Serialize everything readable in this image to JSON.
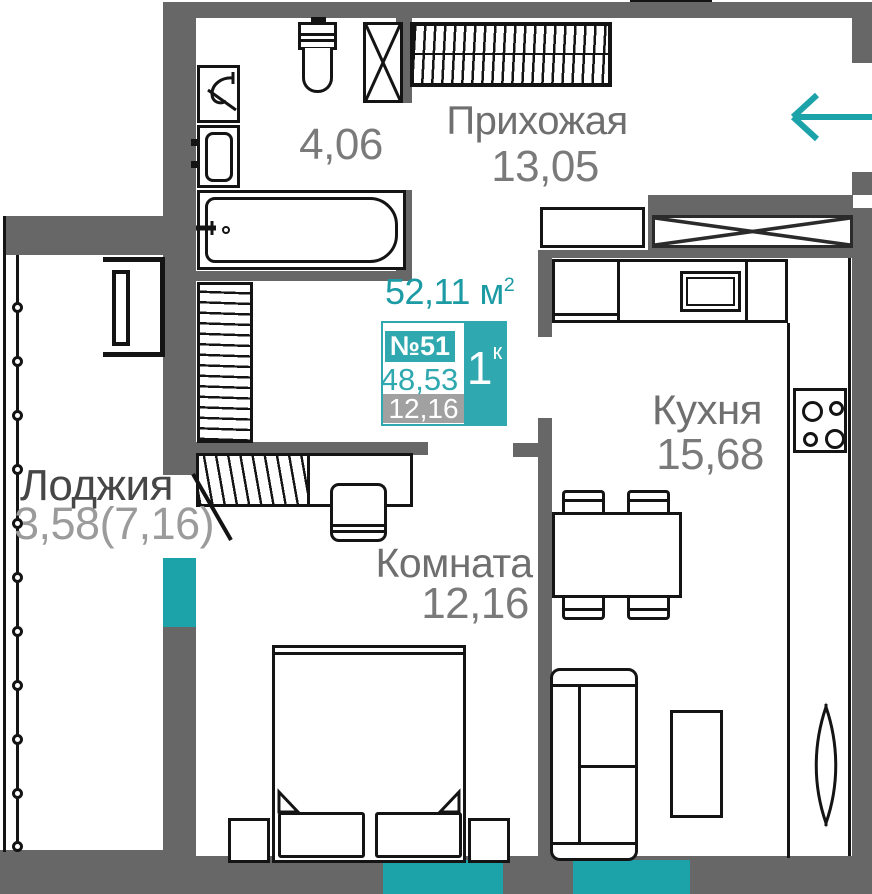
{
  "plan": {
    "title": {
      "area_total": "52,11",
      "unit": "м",
      "unit_sup": "2"
    },
    "badge": {
      "number": "№51",
      "flat_type_num": "1",
      "flat_type_sup": "к",
      "area_living": "48,53",
      "area_room": "12,16"
    },
    "rooms": {
      "hallway": {
        "name": "Прихожая",
        "area": "13,05"
      },
      "bathroom": {
        "area": "4,06"
      },
      "kitchen": {
        "name": "Кухня",
        "area": "15,68"
      },
      "room": {
        "name": "Комната",
        "area": "12,16"
      },
      "loggia": {
        "name": "Лоджия",
        "area": "3,58(7,16)"
      }
    },
    "colors": {
      "accent_teal": "#1CA3A9",
      "badge_teal": "#2FA9AF",
      "wall_gray": "#676767",
      "line_black": "#141414",
      "label_gray": "#6F6F6F",
      "loggia_name_gray": "#464646",
      "loggia_area_gray": "#9B9B9B",
      "muted_box_gray": "#A1A1A1"
    }
  }
}
